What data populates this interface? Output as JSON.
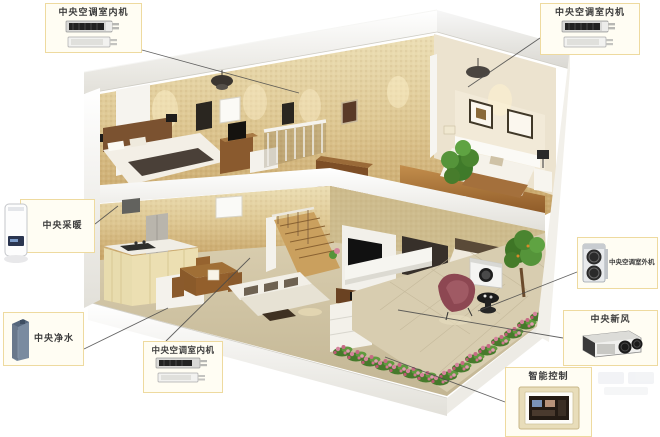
{
  "colors": {
    "callout_border": "#eeda9f",
    "callout_bg": "#fffdf3",
    "label_text": "#3b3b3b",
    "connector_line": "#4a4a4a",
    "wall_gold": "#ddc691",
    "wood_brown": "#8a5a2e",
    "flower_pink": "#d4849c",
    "chair_maroon": "#8d4752"
  },
  "callouts": {
    "top_left_indoor": {
      "label": "中央空调室内机"
    },
    "top_right_indoor": {
      "label": "中央空调室内机"
    },
    "heating": {
      "label": "中央采暖"
    },
    "water_purifier": {
      "label": "中央净水"
    },
    "bottom_indoor": {
      "label": "中央空调室内机"
    },
    "outdoor_unit": {
      "label": "中央空调室外机"
    },
    "fresh_air": {
      "label": "中央新风"
    },
    "smart_control": {
      "label": "智能控制"
    }
  }
}
